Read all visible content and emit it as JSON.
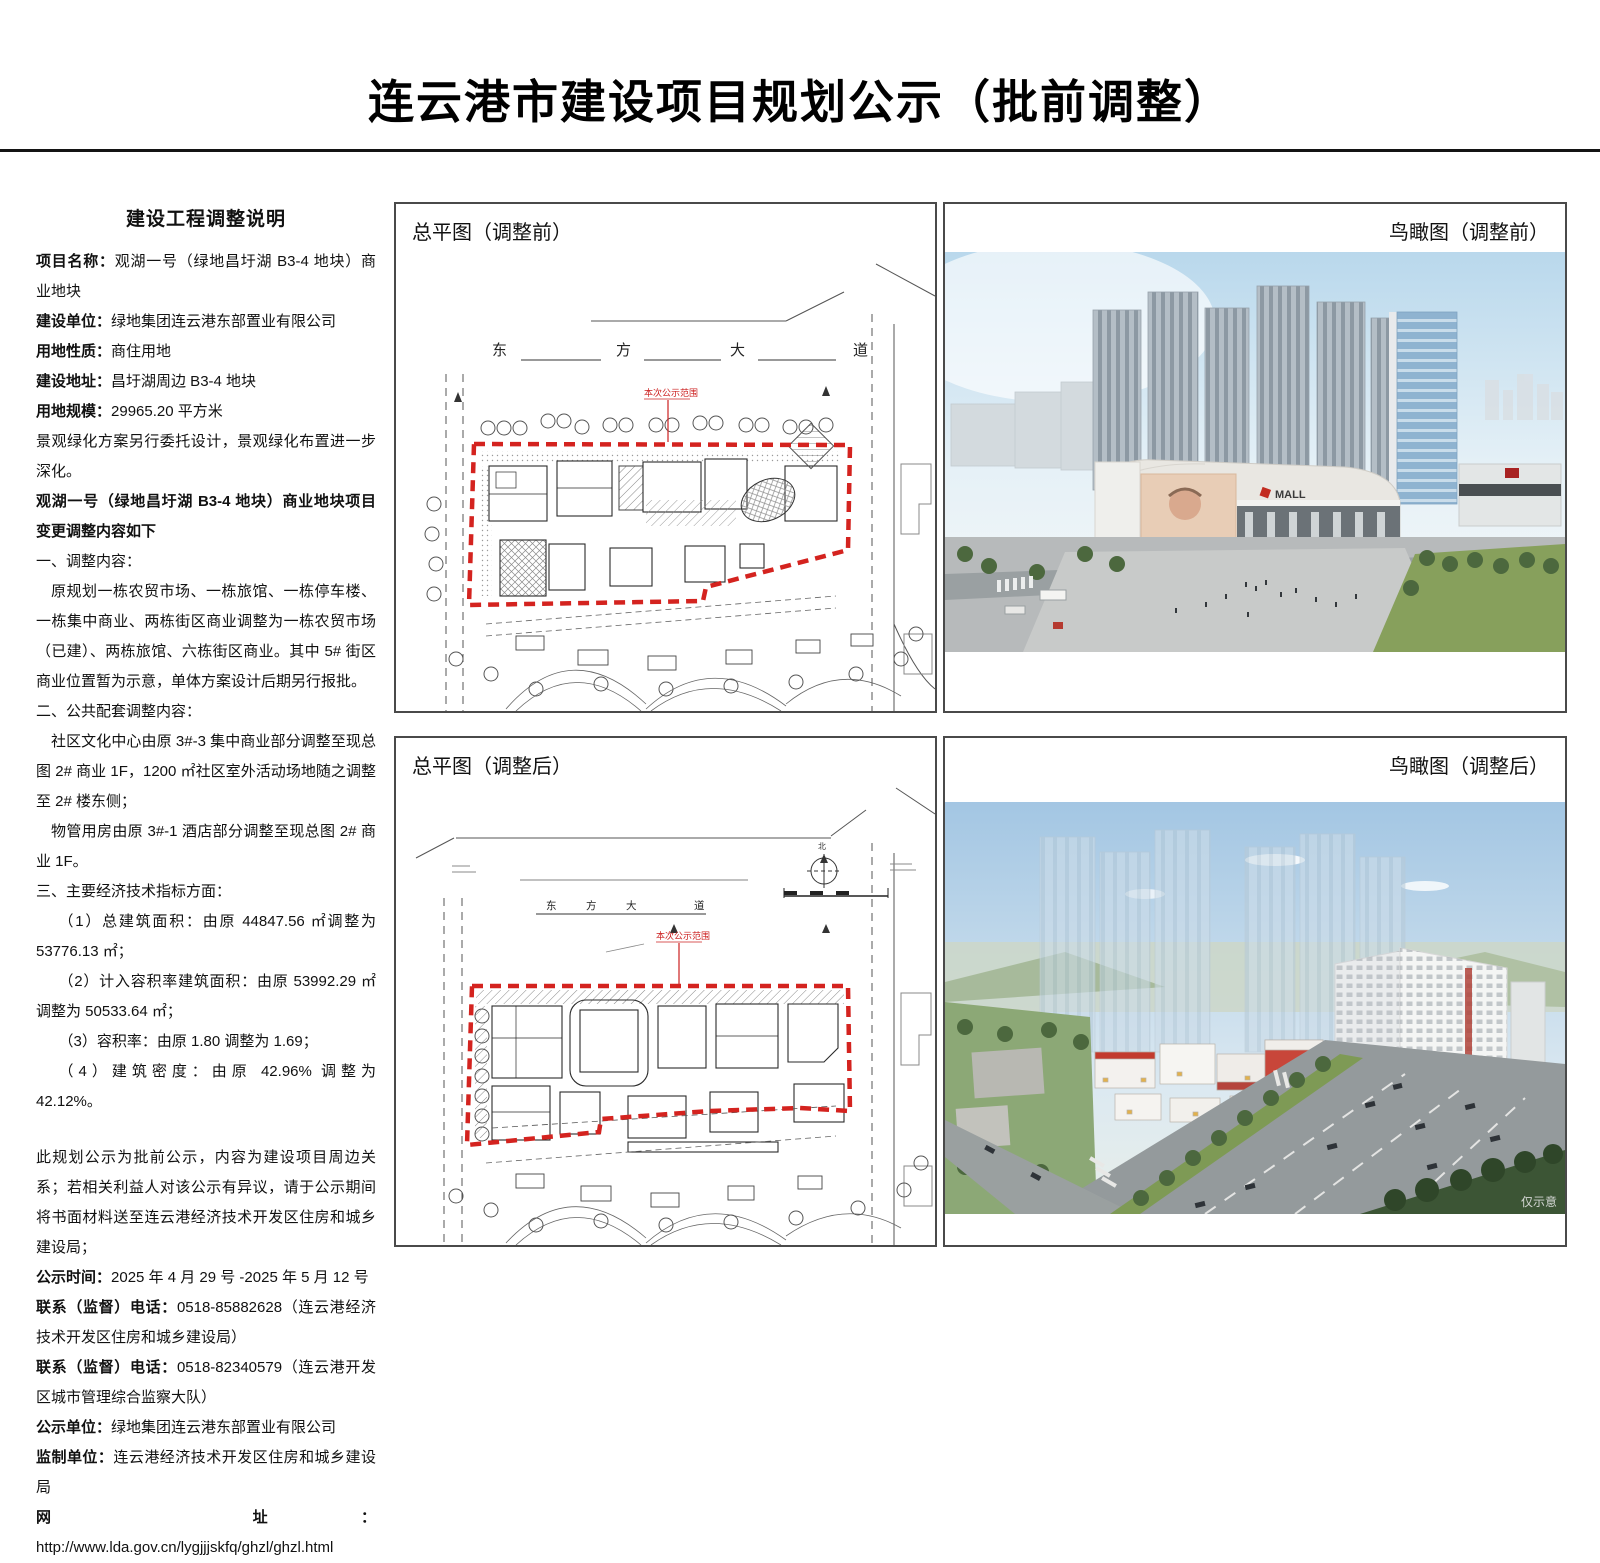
{
  "page": {
    "title": "连云港市建设项目规划公示（批前调整）"
  },
  "description": {
    "heading": "建设工程调整说明",
    "items": [
      {
        "label": "项目名称：",
        "value": "观湖一号（绿地昌圩湖 B3-4 地块）商业地块"
      },
      {
        "label": "建设单位：",
        "value": "绿地集团连云港东部置业有限公司"
      },
      {
        "label": "用地性质：",
        "value": "商住用地"
      },
      {
        "label": "建设地址：",
        "value": "昌圩湖周边 B3-4 地块"
      },
      {
        "label": "用地规模：",
        "value": "29965.20 平方米"
      },
      {
        "label": "",
        "value": "景观绿化方案另行委托设计，景观绿化布置进一步深化。"
      }
    ],
    "change_title": "观湖一号（绿地昌圩湖 B3-4 地块）商业地块项目变更调整内容如下",
    "sections": [
      {
        "heading": "一、调整内容：",
        "paragraphs": [
          "原规划一栋农贸市场、一栋旅馆、一栋停车楼、一栋集中商业、两栋街区商业调整为一栋农贸市场（已建）、两栋旅馆、六栋街区商业。其中 5# 街区商业位置暂为示意，单体方案设计后期另行报批。"
        ]
      },
      {
        "heading": "二、公共配套调整内容：",
        "paragraphs": [
          "社区文化中心由原 3#-3 集中商业部分调整至现总图 2# 商业 1F，1200 ㎡社区室外活动场地随之调整至 2# 楼东侧；",
          "物管用房由原 3#-1 酒店部分调整至现总图 2# 商业 1F。"
        ]
      },
      {
        "heading": "三、主要经济技术指标方面：",
        "paragraphs": [
          "（1）总建筑面积：由原 44847.56 ㎡调整为 53776.13 ㎡；",
          "（2）计入容积率建筑面积：由原 53992.29 ㎡调整为 50533.64 ㎡；",
          "（3）容积率：由原 1.80 调整为 1.69；",
          "（4）建筑密度：由原 42.96% 调整为 42.12%。"
        ]
      }
    ],
    "notice": "此规划公示为批前公示，内容为建设项目周边关系；若相关利益人对该公示有异议，请于公示期间将书面材料送至连云港经济技术开发区住房和城乡建设局；",
    "footer_items": [
      {
        "label": "公示时间：",
        "value": "2025 年 4 月 29 号 -2025 年 5 月 12 号"
      },
      {
        "label": "联系（监督）电话：",
        "value": "0518-85882628（连云港经济技术开发区住房和城乡建设局）"
      },
      {
        "label": "联系（监督）电话：",
        "value": "0518-82340579（连云港开发区城市管理综合监察大队）"
      },
      {
        "label": "公示单位：",
        "value": "绿地集团连云港东部置业有限公司"
      },
      {
        "label": "监制单位：",
        "value": "连云港经济技术开发区住房和城乡建设局"
      },
      {
        "label": "网　址：",
        "value": "http://www.lda.gov.cn/lygjjjskfq/ghzl/ghzl.html"
      }
    ]
  },
  "panels": {
    "site_before": {
      "label": "总平图（调整前）",
      "road_chars": [
        "东",
        "方",
        "大",
        "道"
      ],
      "scope_label": "本次公示范围"
    },
    "aerial_before": {
      "label": "鸟瞰图（调整前）",
      "mall_sign": "MALL"
    },
    "site_after": {
      "label": "总平图（调整后）",
      "road_chars": [
        "东",
        "方",
        "大",
        "道"
      ],
      "north_label": "北",
      "scope_label": "本次公示范围"
    },
    "aerial_after": {
      "label": "鸟瞰图（调整后）",
      "watermark": "仅示意"
    }
  },
  "colors": {
    "boundary_red": "#d4231f",
    "annotation_red": "#cc2020",
    "rule_black": "#141414"
  }
}
